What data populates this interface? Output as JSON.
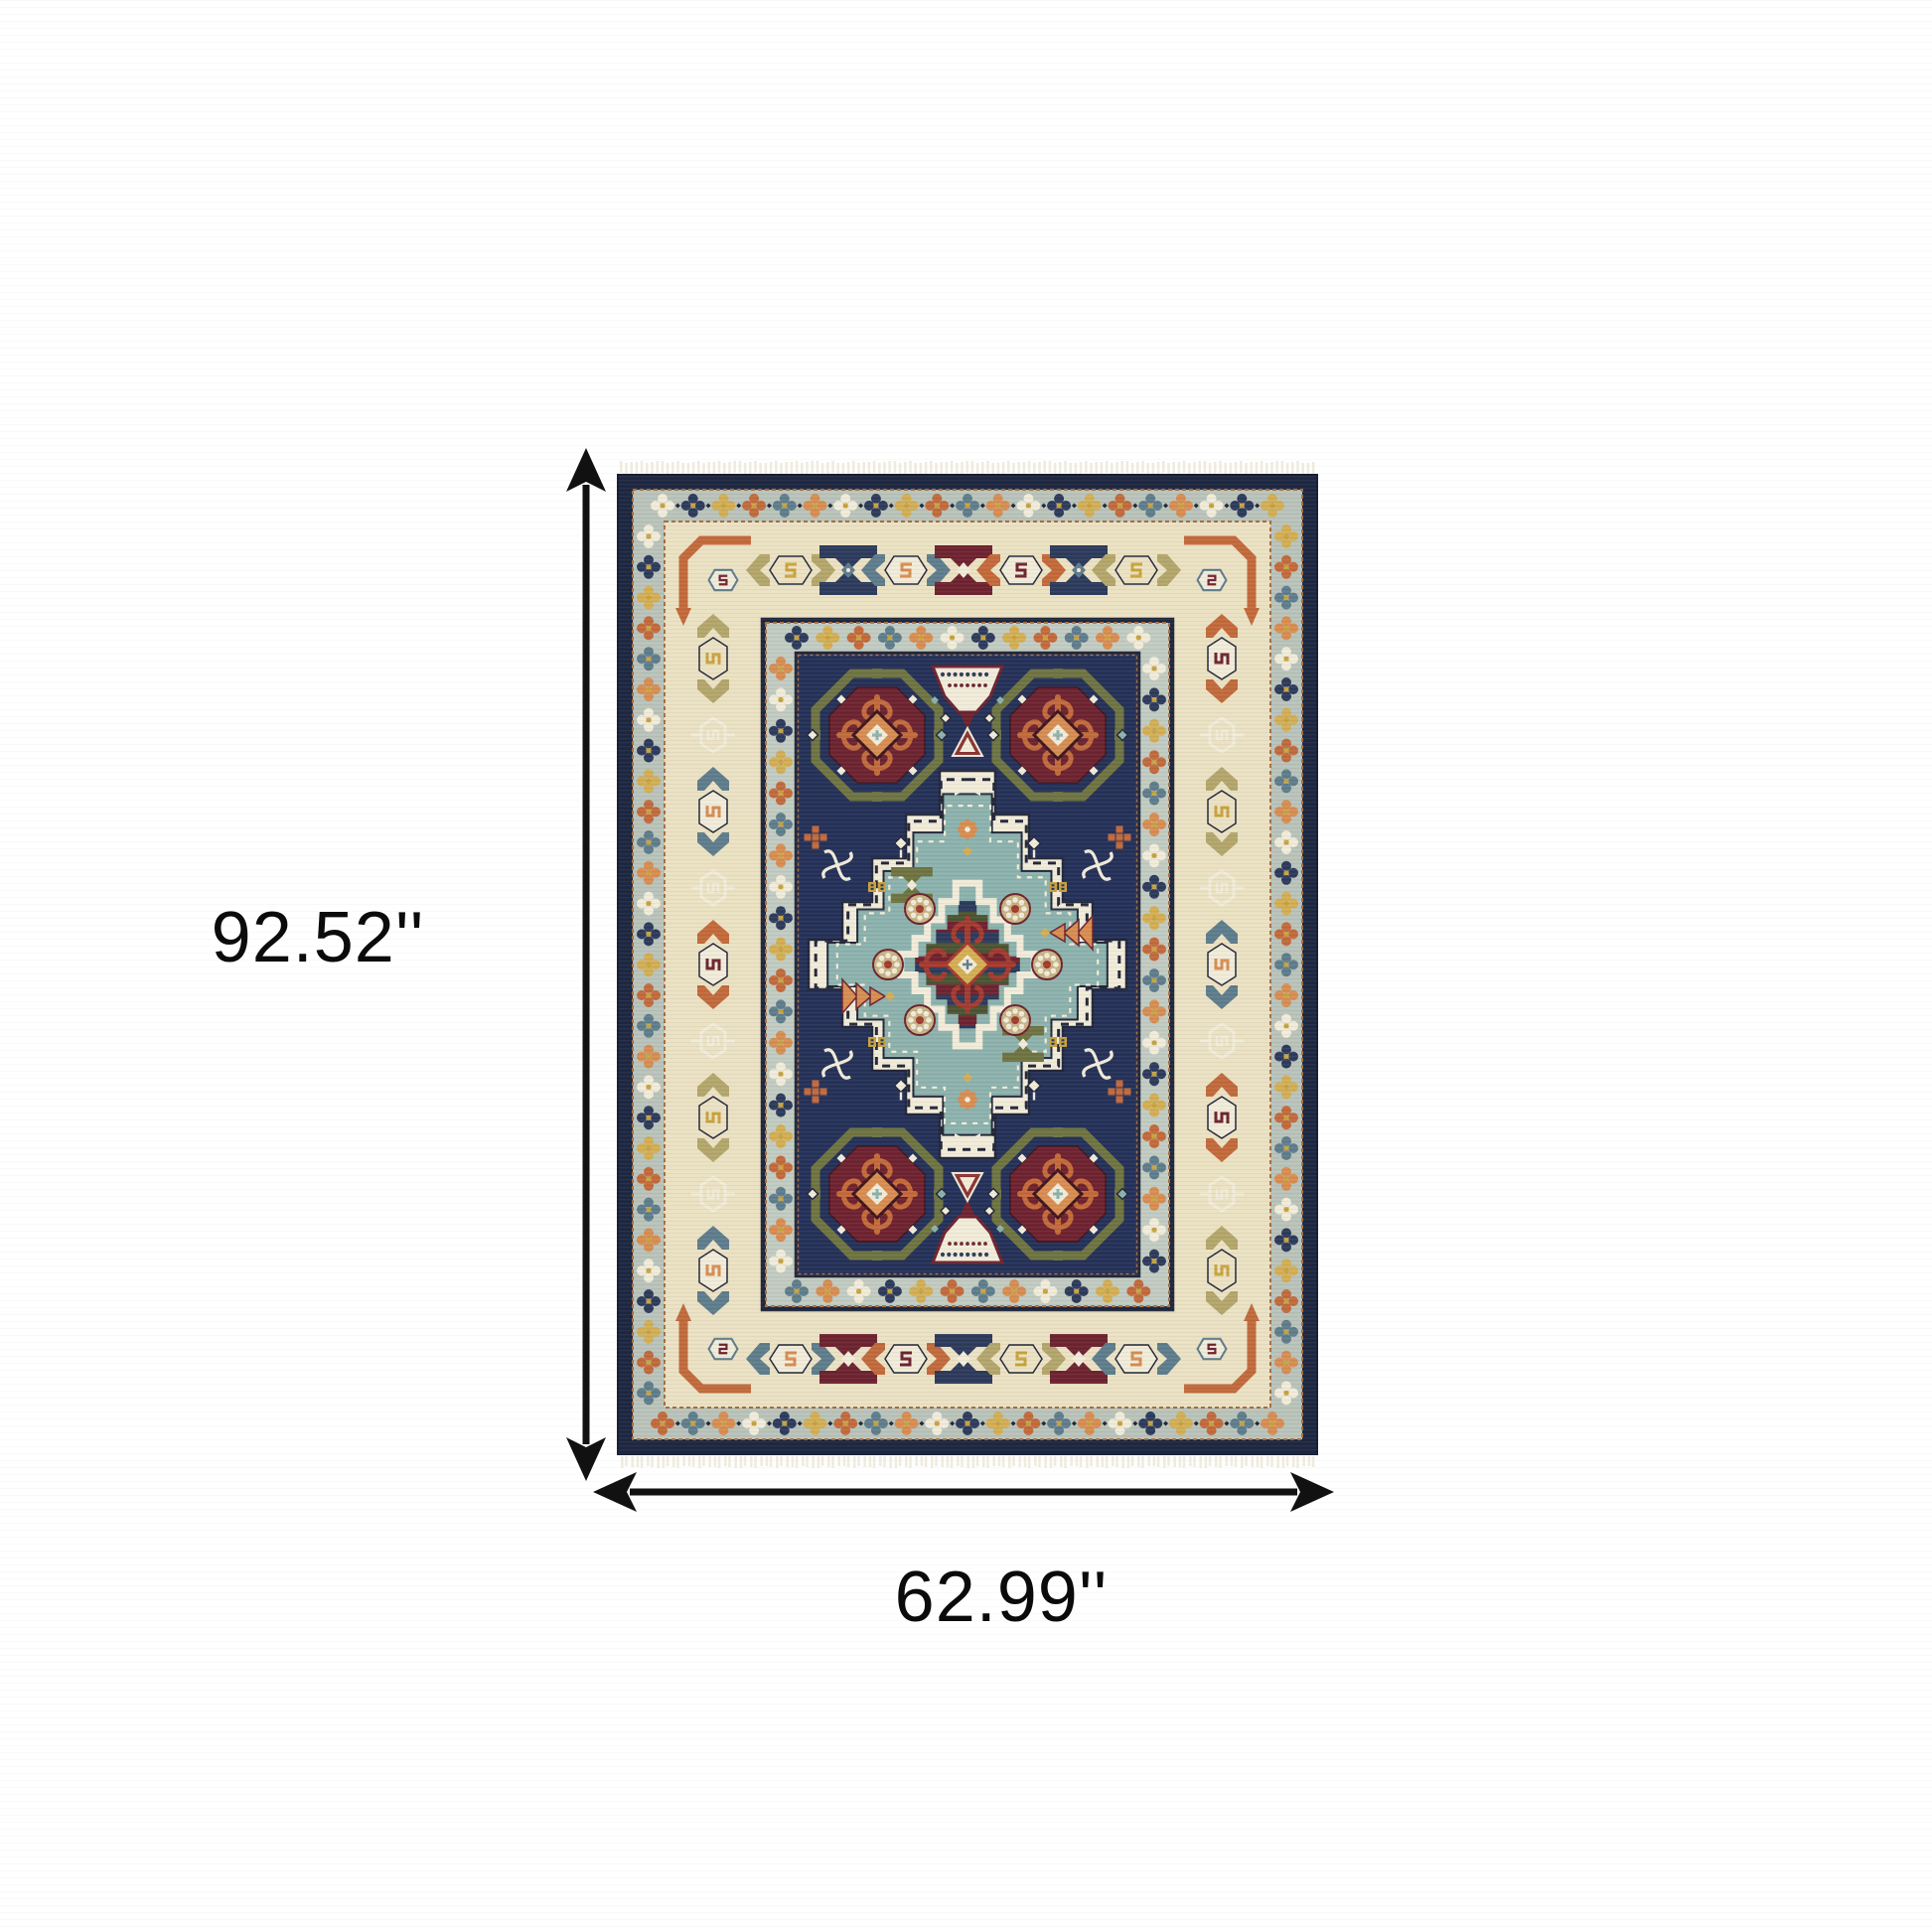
{
  "figure": {
    "alt": "Blue and ivory oriental area rug with fringe"
  },
  "dimensions": {
    "height_label": "92.52''",
    "width_label": "62.99''"
  },
  "annotation": {
    "arrow_color": "#111111",
    "label_color": "#0b0b0b"
  },
  "rug_palette": {
    "navy": "#1d2740",
    "field": "#253158",
    "motif_navy": "#2e3b5c",
    "band": "#b9c3ba",
    "band2": "#c2cbc1",
    "ivory": "#ebe1c3",
    "cream": "#f1ebd9",
    "fringe": "#f0ebdf",
    "ink": "#23283a",
    "maroon": "#6e2430",
    "maroon_dark": "#3f1620",
    "red": "#a33b30",
    "red_base": "#8a3434",
    "rust": "#c26a3c",
    "orange": "#d78d52",
    "olive": "#6f7442",
    "olive_dark": "#4d5433",
    "olive_light": "#b3a66c",
    "slate": "#5f7d8c",
    "teal": "#8db2ad",
    "gold": "#d3ae54",
    "gold_deep": "#c9a33d",
    "khaki": "#c6b385",
    "stitch": "#a96f3f"
  }
}
